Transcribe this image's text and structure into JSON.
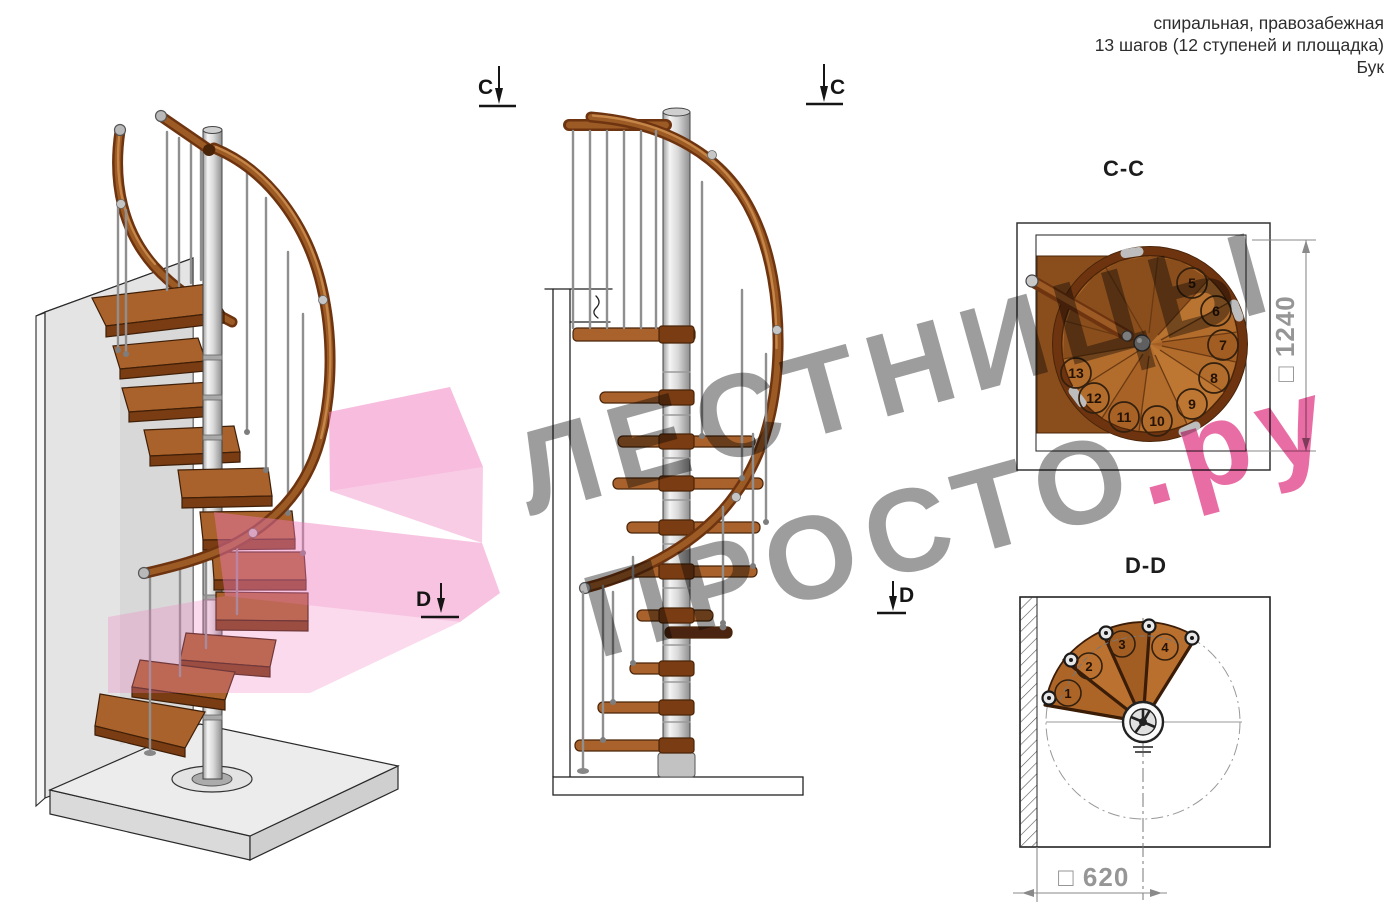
{
  "header_note": {
    "line1": "спиральная, правозабежная",
    "line2": "13 шагов (12 ступеней и площадка)",
    "line3": "Бук"
  },
  "watermark": {
    "line1": "ЛЕСТНИЦЫ",
    "line2_gray": "ПРОСТО",
    "line2_accent": ".ру",
    "gray_color": "#9b9b9b",
    "accent_color": "#ee5f9d"
  },
  "markers": {
    "c": "C",
    "d": "D"
  },
  "cc_view": {
    "title": "C-C",
    "dimension_label": "□ 1240",
    "step_numbers": [
      "5",
      "6",
      "7",
      "8",
      "9",
      "10",
      "11",
      "12",
      "13"
    ]
  },
  "dd_view": {
    "title": "D-D",
    "dimension_label": "□ 620",
    "step_numbers": [
      "1",
      "2",
      "3",
      "4"
    ]
  },
  "materials": {
    "wood": "#b26c2c",
    "rail": "#8a4a1a",
    "metal": "#c9c9c9",
    "highlight_pink": "#ef79bd"
  }
}
